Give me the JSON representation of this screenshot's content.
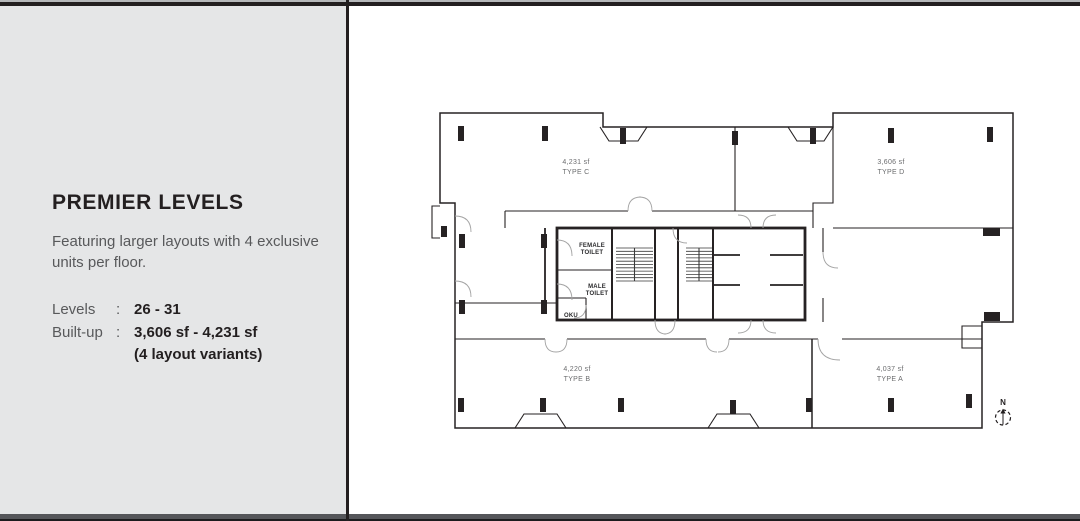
{
  "panel": {
    "title": "PREMIER LEVELS",
    "description": "Featuring larger layouts with 4 exclusive units per floor.",
    "specs": [
      {
        "label": "Levels",
        "sep": ":",
        "value": "26 - 31",
        "note": ""
      },
      {
        "label": "Built-up",
        "sep": ":",
        "value": "3,606 sf - 4,231 sf",
        "note": "(4 layout variants)"
      }
    ]
  },
  "floorplan": {
    "units": [
      {
        "area": "4,231 sf",
        "type": "TYPE C"
      },
      {
        "area": "3,606 sf",
        "type": "TYPE D"
      },
      {
        "area": "4,220 sf",
        "type": "TYPE B"
      },
      {
        "area": "4,037 sf",
        "type": "TYPE A"
      }
    ],
    "rooms": [
      {
        "lines": [
          "FEMALE",
          "TOILET"
        ]
      },
      {
        "lines": [
          "MALE",
          "TOILET"
        ]
      },
      {
        "lines": [
          "OKU"
        ]
      }
    ],
    "compass": {
      "label": "N"
    },
    "colors": {
      "wall": "#262223",
      "door_arc": "#a3a3a3",
      "unit_label": "#6b6c6e",
      "panel_bg": "#e5e6e7",
      "frame_bar": "#55565a"
    }
  }
}
